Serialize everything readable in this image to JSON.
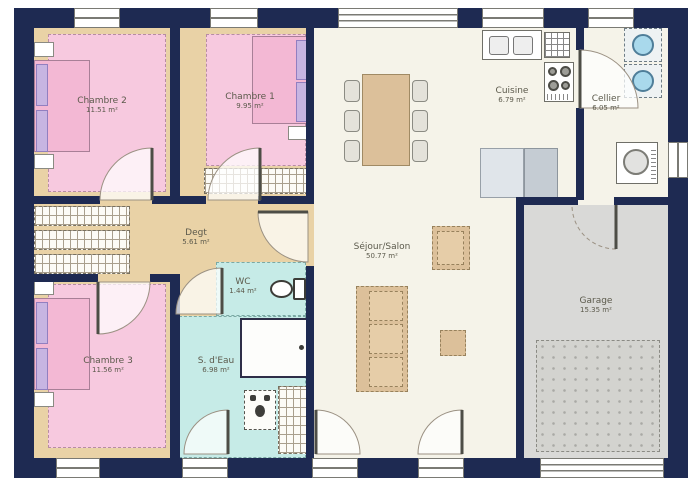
{
  "rooms": {
    "chambre2": {
      "name": "Chambre 2",
      "area": "11.51 m²"
    },
    "chambre1": {
      "name": "Chambre 1",
      "area": "9.95 m²"
    },
    "chambre3": {
      "name": "Chambre 3",
      "area": "11.56 m²"
    },
    "degt": {
      "name": "Degt",
      "area": "5.61 m²"
    },
    "wc": {
      "name": "WC",
      "area": "1.44 m²"
    },
    "salle_eau": {
      "name": "S. d'Eau",
      "area": "6.98 m²"
    },
    "sejour": {
      "name": "Séjour/Salon",
      "area": "50.77 m²"
    },
    "cuisine": {
      "name": "Cuisine",
      "area": "6.79 m²"
    },
    "cellier": {
      "name": "Cellier",
      "area": "6.05 m²"
    },
    "garage": {
      "name": "Garage",
      "area": "15.35 m²"
    }
  },
  "colors": {
    "wall": "#1e2a52",
    "bedroom": "#f7c9df",
    "bed": "#f3b8d4",
    "bath": "#c6ebe7",
    "floor_wood": "#e9d2a6",
    "living": "#f5f3e9",
    "garage_floor": "#d9d9d7",
    "furniture_wood": "#dcc09a",
    "accent_purple": "#c7b5e2",
    "appliance_blue": "#a9d9ec"
  }
}
